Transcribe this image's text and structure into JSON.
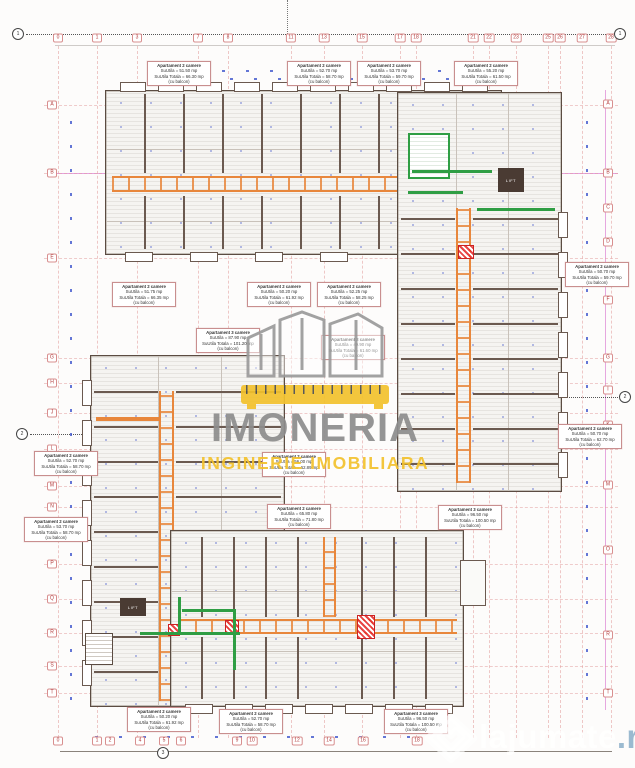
{
  "watermark": {
    "brand": "IMONERIA",
    "tagline": "INGINERIE IMOBILIARA"
  },
  "credit": {
    "site": "lajumate",
    "tld": ".ro"
  },
  "plan": {
    "lift_label": "LIFT"
  },
  "colors": {
    "corridor_orange": "#e8873c",
    "green_wall": "#2f9e44",
    "grid_red": "#e39c9c",
    "magenta": "#cd55cd",
    "dim_blue": "#3d55cc",
    "wall_dark": "#5b4c42",
    "brand_gray": "#8d8d8d",
    "brand_yellow": "#f3c22d"
  },
  "grid": {
    "top_numbers": [
      {
        "n": "0",
        "x": 58
      },
      {
        "n": "1",
        "x": 97
      },
      {
        "n": "3",
        "x": 137
      },
      {
        "n": "7",
        "x": 198
      },
      {
        "n": "8",
        "x": 228
      },
      {
        "n": "11",
        "x": 291
      },
      {
        "n": "13",
        "x": 324
      },
      {
        "n": "15",
        "x": 362
      },
      {
        "n": "17",
        "x": 400
      },
      {
        "n": "18",
        "x": 416
      },
      {
        "n": "21",
        "x": 473
      },
      {
        "n": "22",
        "x": 489
      },
      {
        "n": "23",
        "x": 516
      },
      {
        "n": "25",
        "x": 548
      },
      {
        "n": "26",
        "x": 560
      },
      {
        "n": "27",
        "x": 582
      },
      {
        "n": "28",
        "x": 611
      }
    ],
    "bottom_numbers": [
      {
        "n": "0",
        "x": 58
      },
      {
        "n": "1",
        "x": 97
      },
      {
        "n": "2",
        "x": 110
      },
      {
        "n": "4",
        "x": 140
      },
      {
        "n": "5",
        "x": 164
      },
      {
        "n": "6",
        "x": 181
      },
      {
        "n": "9",
        "x": 237
      },
      {
        "n": "10",
        "x": 252
      },
      {
        "n": "12",
        "x": 297
      },
      {
        "n": "14",
        "x": 329
      },
      {
        "n": "16",
        "x": 363
      },
      {
        "n": "18",
        "x": 417
      }
    ],
    "left_letters": [
      {
        "n": "A",
        "y": 105
      },
      {
        "n": "B",
        "y": 173
      },
      {
        "n": "E",
        "y": 258
      },
      {
        "n": "G",
        "y": 358
      },
      {
        "n": "H",
        "y": 383
      },
      {
        "n": "J",
        "y": 413
      },
      {
        "n": "L",
        "y": 449
      },
      {
        "n": "M",
        "y": 486
      },
      {
        "n": "N",
        "y": 507
      },
      {
        "n": "P",
        "y": 564
      },
      {
        "n": "Q",
        "y": 599
      },
      {
        "n": "R",
        "y": 633
      },
      {
        "n": "S",
        "y": 666
      },
      {
        "n": "T",
        "y": 693
      }
    ],
    "right_letters": [
      {
        "n": "A",
        "y": 104
      },
      {
        "n": "B",
        "y": 173
      },
      {
        "n": "C",
        "y": 208
      },
      {
        "n": "D",
        "y": 242
      },
      {
        "n": "F",
        "y": 300
      },
      {
        "n": "G",
        "y": 358
      },
      {
        "n": "I",
        "y": 390
      },
      {
        "n": "K",
        "y": 425
      },
      {
        "n": "M",
        "y": 485
      },
      {
        "n": "O",
        "y": 550
      },
      {
        "n": "R",
        "y": 635
      },
      {
        "n": "T",
        "y": 693
      }
    ]
  },
  "section_markers": [
    {
      "n": "1",
      "x": 18,
      "y": 34
    },
    {
      "n": "1",
      "x": 620,
      "y": 34
    },
    {
      "n": "2",
      "x": 22,
      "y": 434
    },
    {
      "n": "2",
      "x": 625,
      "y": 397
    },
    {
      "n": "3",
      "x": 163,
      "y": 753
    }
  ],
  "apartment_labels": [
    {
      "x": 147,
      "y": 61,
      "lines": [
        "Apartament 2 camere",
        "SuUtila = 51.50 mp",
        "SuUtila Totala = 66.30 mp",
        "(cu balcon)"
      ]
    },
    {
      "x": 287,
      "y": 61,
      "lines": [
        "Apartament 2 camere",
        "SuUtila = 52.70 mp",
        "SuUtila Totala = 58.70 mp",
        "(cu balcon)"
      ]
    },
    {
      "x": 357,
      "y": 61,
      "lines": [
        "Apartament 2 camere",
        "SuUtila = 53.70 mp",
        "SuUtila Totala = 59.70 mp",
        "(cu balcon)"
      ]
    },
    {
      "x": 454,
      "y": 61,
      "lines": [
        "Apartament 2 camere",
        "SuUtila = 55.20 mp",
        "SuUtila Totala = 61.50 mp",
        "(cu balcon)"
      ]
    },
    {
      "x": 112,
      "y": 282,
      "lines": [
        "Apartament 2 camere",
        "SuUtila = 51.75 mp",
        "SuUtila Totala = 66.35 mp",
        "(cu balcon)"
      ]
    },
    {
      "x": 247,
      "y": 282,
      "lines": [
        "Apartament 2 camere",
        "SuUtila = 50.20 mp",
        "SuUtila Totala = 61.92 mp",
        "(cu balcon)"
      ]
    },
    {
      "x": 317,
      "y": 282,
      "lines": [
        "Apartament 2 camere",
        "SuUtila = 52.25 mp",
        "SuUtila Totala = 58.25 mp",
        "(cu balcon)"
      ]
    },
    {
      "x": 565,
      "y": 262,
      "lines": [
        "Apartament 2 camere",
        "SuUtila = 50.70 mp",
        "SuUtila Totala = 59.70 mp",
        "(cu balcon)"
      ]
    },
    {
      "x": 558,
      "y": 424,
      "lines": [
        "Apartament 2 camere",
        "SuUtila = 50.70 mp",
        "SuUtila Totala = 62.70 mp",
        "(cu balcon)"
      ]
    },
    {
      "x": 196,
      "y": 328,
      "lines": [
        "Apartament 3 camere",
        "SuUtila = 87.90 mp",
        "SuUtila Totala = 101.20 mp",
        "(cu balcon)"
      ]
    },
    {
      "x": 321,
      "y": 335,
      "lines": [
        "Apartament 2 camere",
        "SuUtila = 49.90 mp",
        "SuUtila Totala = 61.60 mp",
        "(cu balcon)"
      ]
    },
    {
      "x": 262,
      "y": 452,
      "lines": [
        "Apartament 2 camere",
        "SuUtila = 56.00 mp",
        "SuUtila Totala = 62.89 mp",
        "(cu balcon)"
      ]
    },
    {
      "x": 267,
      "y": 504,
      "lines": [
        "Apartament 2 camere",
        "SuUtila = 65.80 mp",
        "SuUtila Totala = 71.80 mp",
        "(cu balcon)"
      ]
    },
    {
      "x": 438,
      "y": 505,
      "lines": [
        "Apartament 3 camere",
        "SuUtila = 96.50 mp",
        "SuUtila Totala = 100.50 mp",
        "(cu balcon)"
      ]
    },
    {
      "x": 34,
      "y": 451,
      "lines": [
        "Apartament 2 camere",
        "SuUtila = 52.70 mp",
        "SuUtila Totala = 58.70 mp",
        "(cu balcon)"
      ]
    },
    {
      "x": 24,
      "y": 517,
      "lines": [
        "Apartament 2 camere",
        "SuUtila = 53.70 mp",
        "SuUtila Totala = 58.70 mp",
        "(cu balcon)"
      ]
    },
    {
      "x": 127,
      "y": 707,
      "lines": [
        "Apartament 2 camere",
        "SuUtila = 50.20 mp",
        "SuUtila Totala = 61.92 mp",
        "(cu balcon)"
      ]
    },
    {
      "x": 219,
      "y": 709,
      "lines": [
        "Apartament 2 camere",
        "SuUtila = 52.70 mp",
        "SuUtila Totala = 58.70 mp",
        "(cu balcon)"
      ]
    },
    {
      "x": 384,
      "y": 709,
      "lines": [
        "Apartament 3 camere",
        "SuUtila = 96.50 mp",
        "SuUtila Totala = 100.50 mp",
        "(cu balcon)"
      ]
    }
  ]
}
